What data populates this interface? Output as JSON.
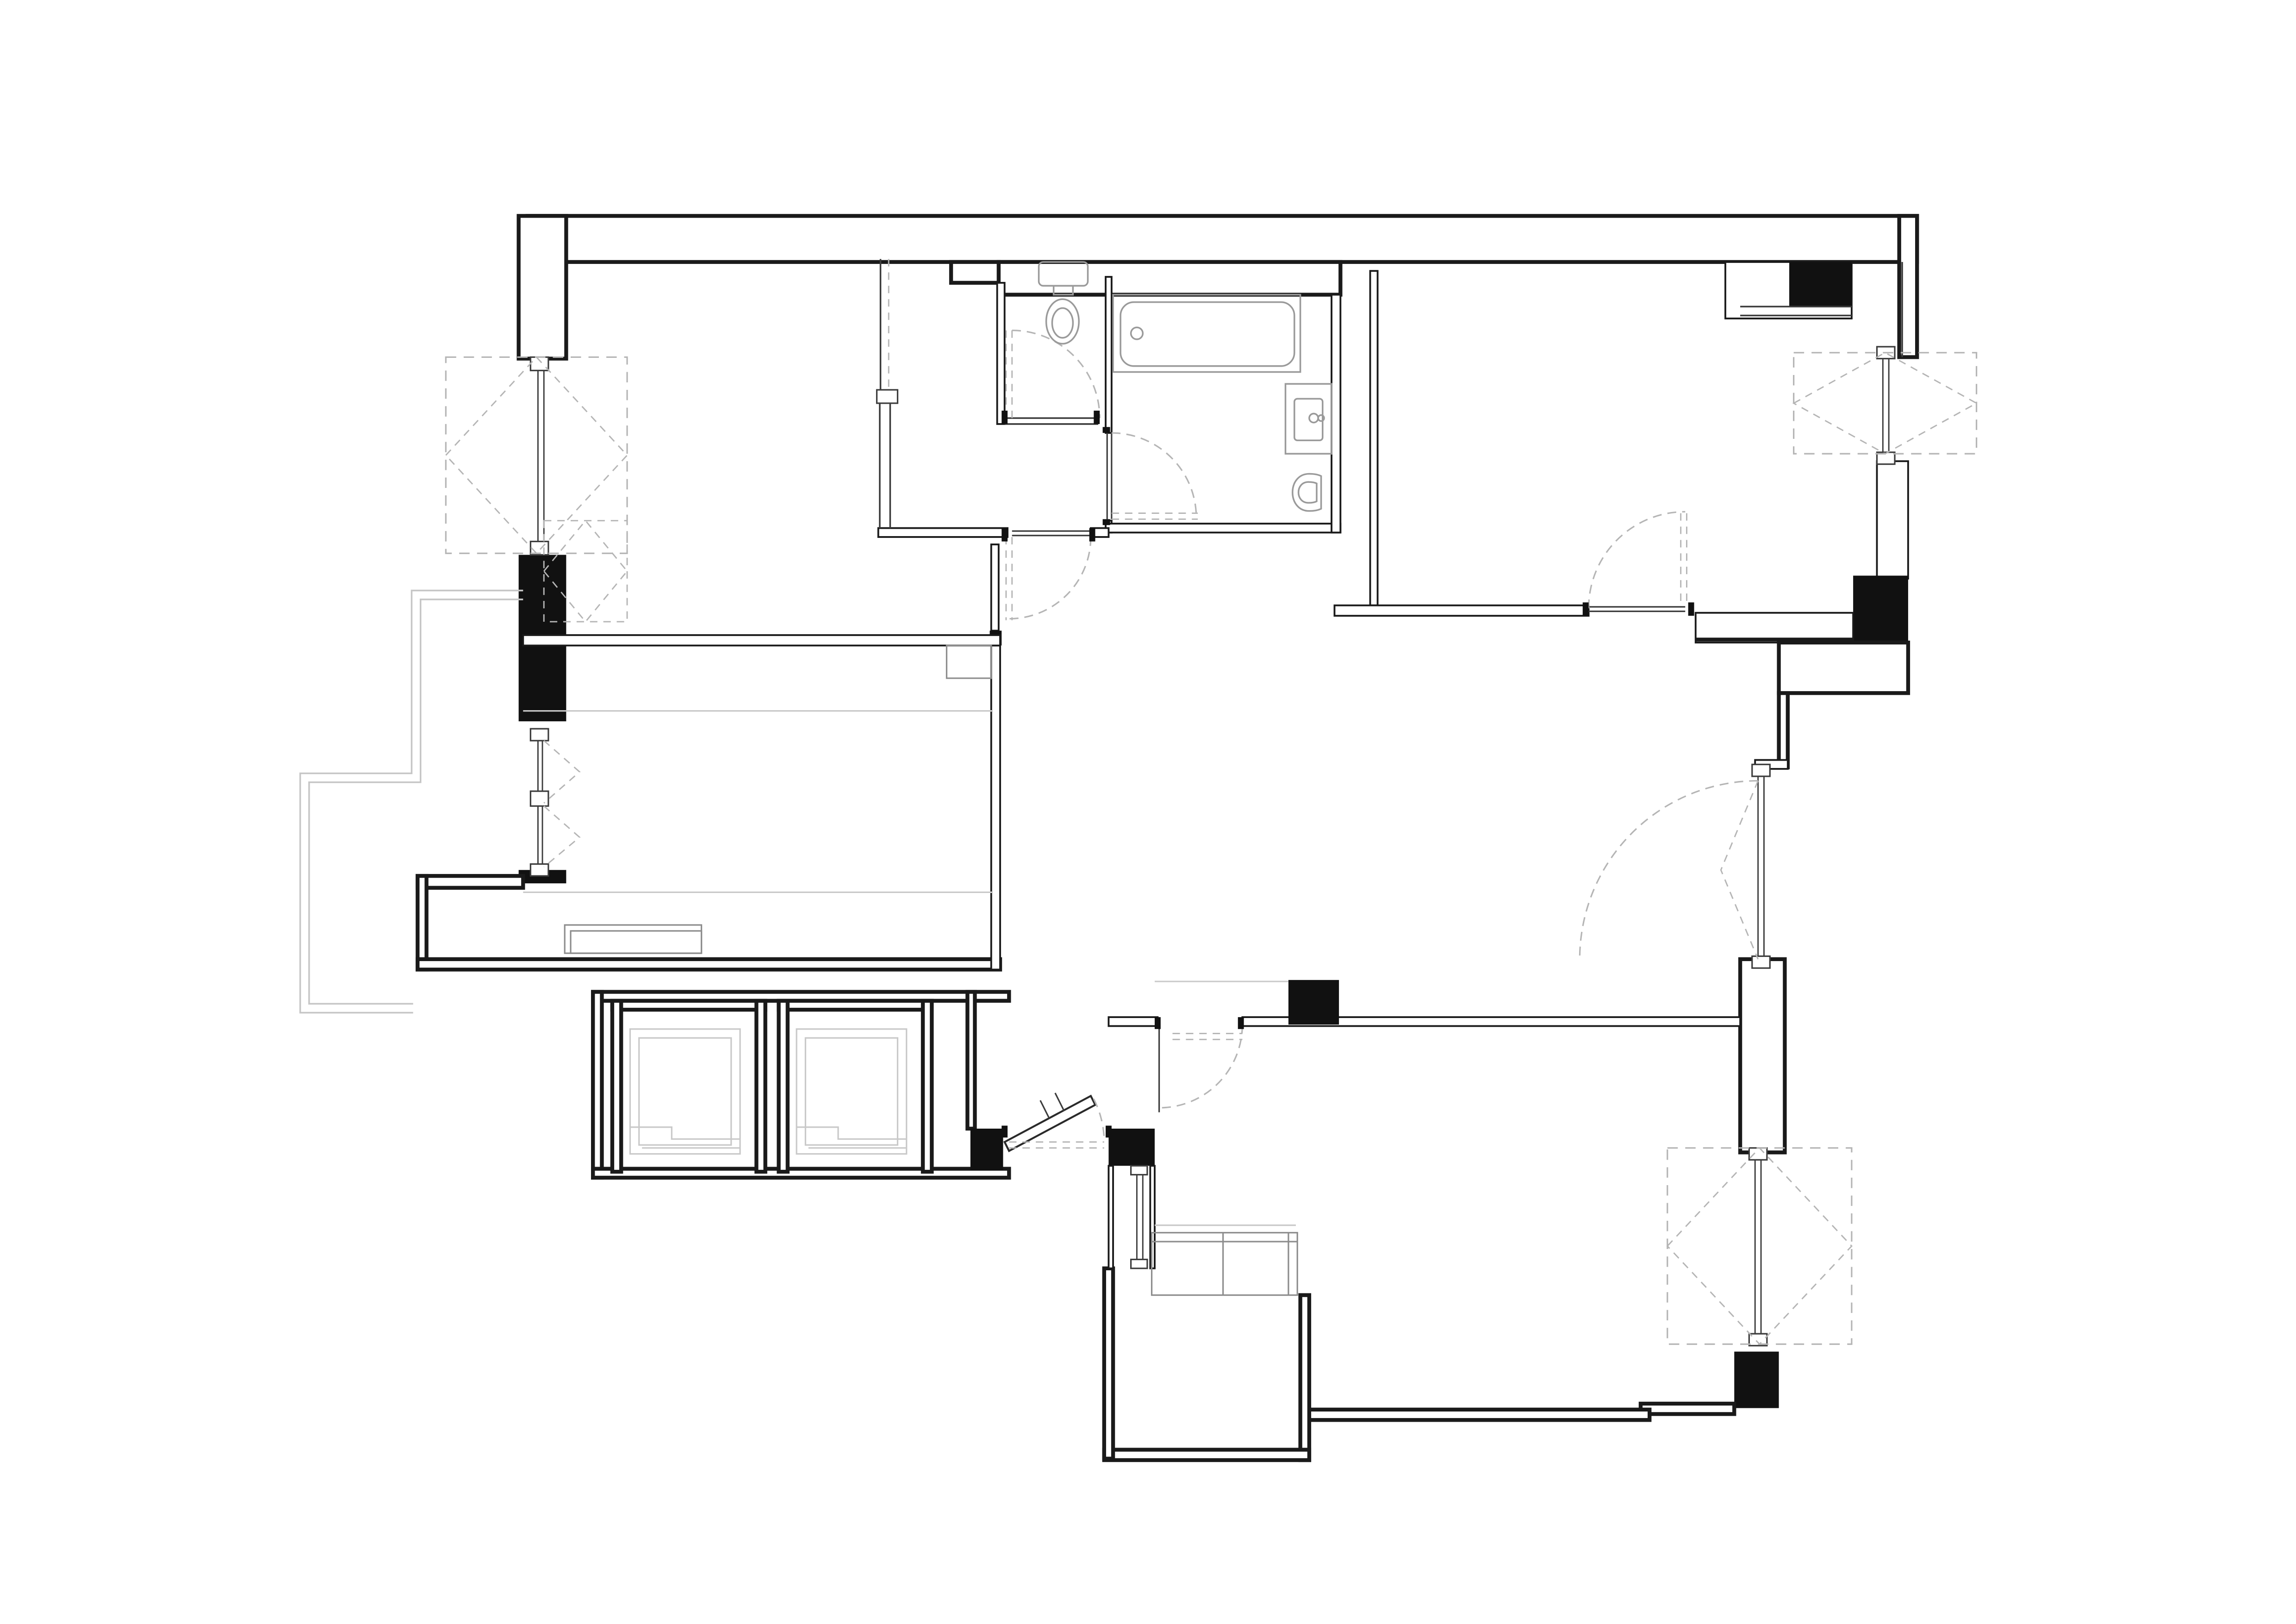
{
  "document": {
    "kind": "architectural-floor-plan",
    "visible_text": [],
    "background_color": "#ffffff"
  },
  "colors": {
    "background": "#ffffff",
    "wall_line": "#1a1a1a",
    "pier_fill": "#111111",
    "thin_line": "#3c3c3c",
    "dashed_symbol": "#b5b5b5",
    "fixture_line": "#9a9a9a",
    "balcony_line": "#c6c6c6",
    "furniture_line": "#8d8d8d"
  },
  "elements": {
    "windows": [
      {
        "icon": "casement-window-icon",
        "location": "left-wall-upper",
        "symbol": "dashed-square-diamond-outside"
      },
      {
        "icon": "french-window-icon",
        "location": "left-wall-lower",
        "symbol": "double-casement-v-dashes"
      },
      {
        "icon": "casement-window-icon",
        "location": "right-wall-top",
        "symbol": "dashed-square-diamond-outside"
      },
      {
        "icon": "glazed-door-icon",
        "location": "right-wall-middle",
        "symbol": "dashed-swing"
      },
      {
        "icon": "casement-window-icon",
        "location": "right-wall-bottom",
        "symbol": "dashed-square-diamond-outside"
      }
    ],
    "doors": [
      {
        "icon": "door-swing-icon",
        "location": "wc"
      },
      {
        "icon": "door-swing-icon",
        "location": "bathroom"
      },
      {
        "icon": "door-swing-icon",
        "location": "hall-to-bedroom-left"
      },
      {
        "icon": "door-swing-icon",
        "location": "bedroom-right"
      },
      {
        "icon": "door-swing-icon",
        "location": "kitchen-living"
      },
      {
        "icon": "entry-door-icon",
        "location": "entrance",
        "state": "ajar"
      }
    ],
    "fixtures": [
      {
        "icon": "toilet-icon",
        "location": "wc"
      },
      {
        "icon": "bathtub-icon",
        "location": "bathroom"
      },
      {
        "icon": "washbasin-icon",
        "location": "bathroom"
      },
      {
        "icon": "bidet-icon",
        "location": "bathroom"
      }
    ],
    "service": [
      {
        "icon": "elevator-car-icon",
        "count": 2,
        "location": "bottom-left-core"
      },
      {
        "icon": "wardrobe-sliding-icon",
        "location": "bedroom-left"
      },
      {
        "icon": "counter-icon",
        "location": "kitchen-bay"
      },
      {
        "icon": "cabinet-icon",
        "location": "living-room"
      },
      {
        "icon": "balcony-outline-icon",
        "location": "left-exterior"
      }
    ]
  }
}
